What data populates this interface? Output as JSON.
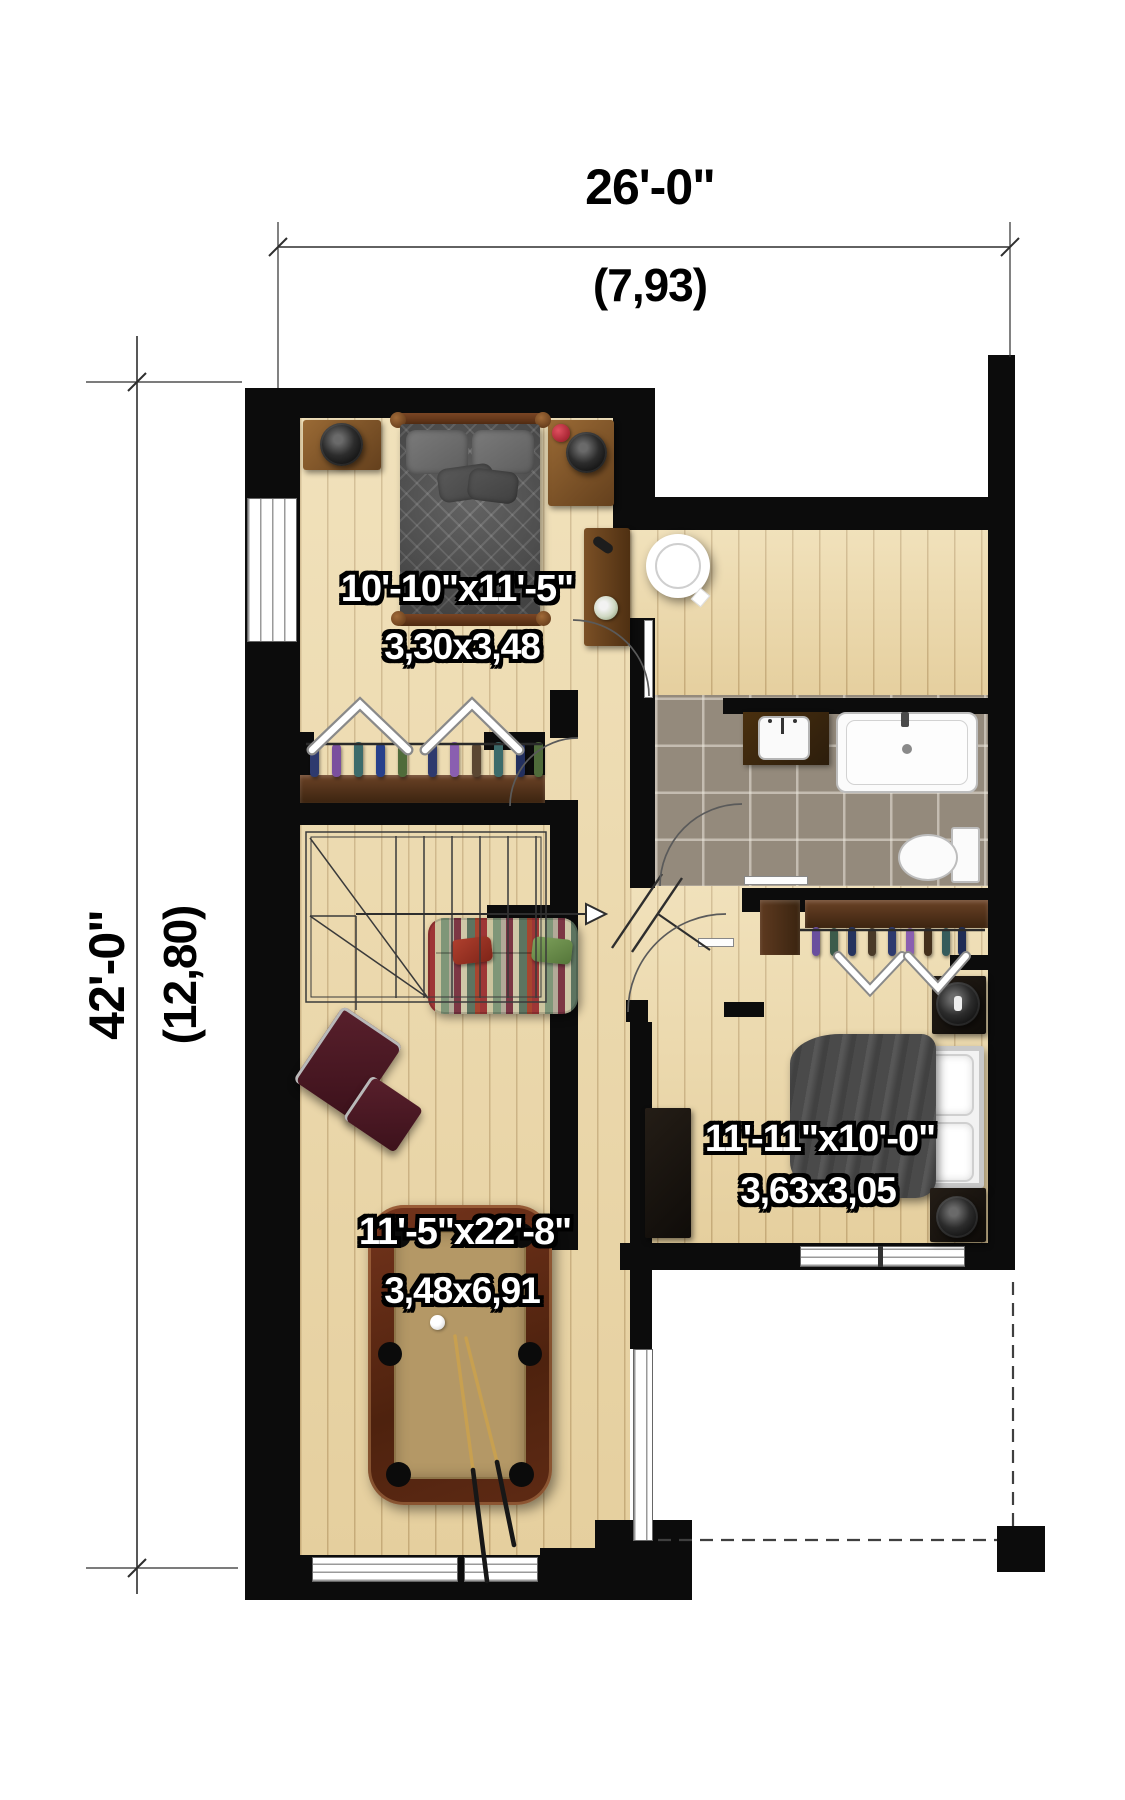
{
  "dimensions": {
    "top": {
      "feet": "26'-0\"",
      "meters": "(7,93)"
    },
    "side": {
      "feet": "42'-0\"",
      "meters": "(12,80)"
    }
  },
  "rooms": {
    "bedroom_top": {
      "feet": "10'-10\"x11'-5\"",
      "meters": "3,30x3,48"
    },
    "bedroom_right": {
      "feet": "11'-11\"x10'-0\"",
      "meters": "3,63x3,05"
    },
    "family_room": {
      "feet": "11'-5\"x22'-8\"",
      "meters": "3,48x6,91"
    }
  }
}
